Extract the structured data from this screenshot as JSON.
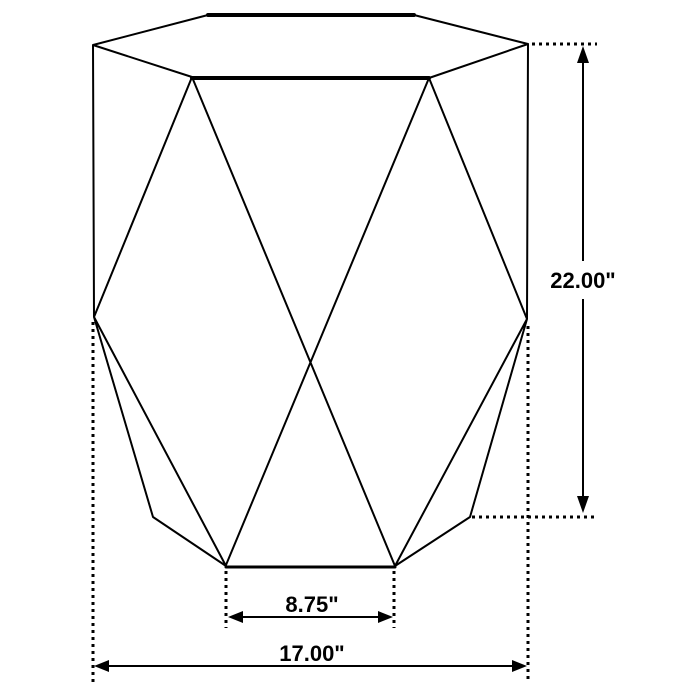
{
  "drawing": {
    "background_color": "#ffffff",
    "stroke_color": "#000000",
    "labels": {
      "height": "22.00\"",
      "base_width": "8.75\"",
      "overall_width": "17.00\""
    }
  }
}
